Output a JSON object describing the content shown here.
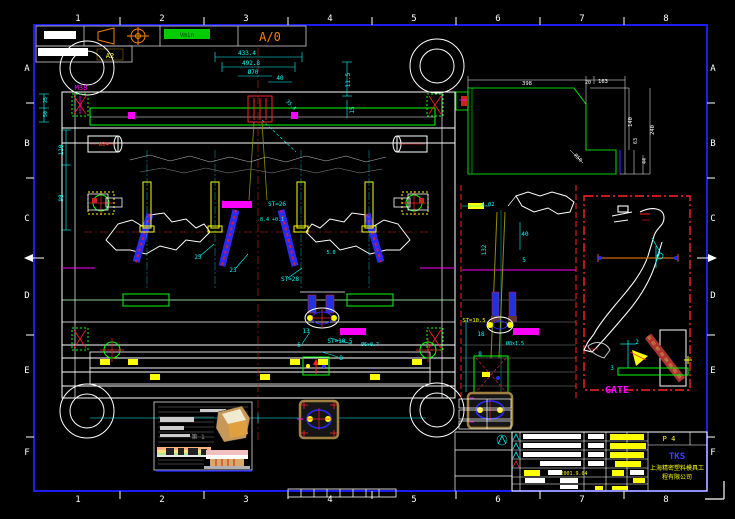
{
  "border": {
    "columns": [
      "1",
      "2",
      "3",
      "4",
      "5",
      "6",
      "7",
      "8"
    ],
    "rows": [
      "A",
      "B",
      "C",
      "D",
      "E",
      "F"
    ]
  },
  "corner": {
    "revision": "A/0",
    "badge": "Vmin",
    "tag": "A2"
  },
  "title_block": {
    "page": "P 4",
    "logo": "TKS",
    "company_line1": "上海精密塑料模具工",
    "company_line2": "程有限公司",
    "date": "2001.9.04"
  },
  "annotations": [
    {
      "text": "M38",
      "x": 81,
      "y": 90,
      "color": "#ff00ff",
      "size": 7
    },
    {
      "text": "433.4",
      "x": 247,
      "y": 55,
      "color": "#00ffff"
    },
    {
      "text": "492.8",
      "x": 251,
      "y": 65,
      "color": "#00ffff"
    },
    {
      "text": "Ø70",
      "x": 253,
      "y": 74,
      "color": "#00ffff"
    },
    {
      "text": "40",
      "x": 280,
      "y": 80,
      "color": "#00ffff"
    },
    {
      "text": "11.5",
      "x": 350,
      "y": 80,
      "color": "#00ffff",
      "rot": -90
    },
    {
      "text": "15",
      "x": 354,
      "y": 110,
      "color": "#00ffff",
      "rot": -90
    },
    {
      "text": "110",
      "x": 63,
      "y": 150,
      "color": "#00ffff",
      "rot": -90
    },
    {
      "text": "98",
      "x": 63,
      "y": 198,
      "color": "#00ffff",
      "rot": -90
    },
    {
      "text": "25",
      "x": 47,
      "y": 100,
      "color": "#00ffff",
      "rot": -90,
      "size": 5
    },
    {
      "text": "50",
      "x": 47,
      "y": 114,
      "color": "#00ffff",
      "rot": -90,
      "size": 5
    },
    {
      "text": "Ø24",
      "x": 104,
      "y": 146,
      "color": "#ff3333",
      "size": 5.5
    },
    {
      "text": "35.4",
      "x": 290,
      "y": 106,
      "color": "#00ffff",
      "rot": 45,
      "size": 5
    },
    {
      "text": "ST=26",
      "x": 277,
      "y": 206,
      "color": "#00ffff"
    },
    {
      "text": "8.4 +0.1",
      "x": 272,
      "y": 221,
      "color": "#00ffff",
      "size": 5
    },
    {
      "text": "ST=28",
      "x": 290,
      "y": 281,
      "color": "#00ffff"
    },
    {
      "text": "25",
      "x": 198,
      "y": 259,
      "color": "#00ffff"
    },
    {
      "text": "23",
      "x": 233,
      "y": 272,
      "color": "#00ffff"
    },
    {
      "text": "5.0",
      "x": 331,
      "y": 254,
      "color": "#00ffff",
      "size": 5
    },
    {
      "text": "13",
      "x": 306,
      "y": 333,
      "color": "#00ffff"
    },
    {
      "text": "5",
      "x": 299,
      "y": 347,
      "color": "#00ffff"
    },
    {
      "text": "ST=10.5",
      "x": 340,
      "y": 343,
      "color": "#00ffff"
    },
    {
      "text": "Ø6×0.7",
      "x": 370,
      "y": 346,
      "color": "#00ffff",
      "size": 5
    },
    {
      "text": "8",
      "x": 341,
      "y": 360,
      "color": "#00ffff"
    },
    {
      "text": "4.02",
      "x": 488,
      "y": 206,
      "color": "#00ffff",
      "size": 5.5
    },
    {
      "text": "40",
      "x": 525,
      "y": 236,
      "color": "#00ffff"
    },
    {
      "text": "132",
      "x": 486,
      "y": 250,
      "color": "#00ffff",
      "rot": -90
    },
    {
      "text": "5",
      "x": 524,
      "y": 262,
      "color": "#00ffff"
    },
    {
      "text": "ST=10.5",
      "x": 474,
      "y": 322,
      "color": "#ffff00",
      "size": 5.5
    },
    {
      "text": "18",
      "x": 481,
      "y": 336,
      "color": "#00ffff"
    },
    {
      "text": "Ø8×1.5",
      "x": 515,
      "y": 345,
      "color": "#00ffff",
      "size": 5
    },
    {
      "text": "8",
      "x": 480,
      "y": 356,
      "color": "#00ffff"
    },
    {
      "text": "GATE",
      "x": 617,
      "y": 393,
      "color": "#ff00ff",
      "size": 10,
      "bold": true
    },
    {
      "text": "2",
      "x": 637,
      "y": 344,
      "color": "#00ffff"
    },
    {
      "text": "3",
      "x": 612,
      "y": 370,
      "color": "#00ffff"
    },
    {
      "text": "398",
      "x": 527,
      "y": 85,
      "color": "#ffffff",
      "size": 5.5
    },
    {
      "text": "20",
      "x": 588,
      "y": 84,
      "color": "#ffffff",
      "size": 5
    },
    {
      "text": "163",
      "x": 603,
      "y": 83,
      "color": "#ffffff",
      "size": 5.5
    },
    {
      "text": "140",
      "x": 632,
      "y": 122,
      "color": "#ffffff",
      "rot": -90,
      "size": 5.5
    },
    {
      "text": "240",
      "x": 654,
      "y": 130,
      "color": "#ffffff",
      "rot": -90,
      "size": 5.5
    },
    {
      "text": "63",
      "x": 637,
      "y": 141,
      "color": "#ffffff",
      "rot": -90,
      "size": 5
    },
    {
      "text": "44",
      "x": 646,
      "y": 161,
      "color": "#ffffff",
      "rot": -90,
      "size": 5
    },
    {
      "text": "R50",
      "x": 577,
      "y": 159,
      "color": "#ffffff",
      "rot": 45,
      "size": 5
    },
    {
      "text": "第 1",
      "x": 198,
      "y": 439,
      "color": "#999999",
      "size": 6
    },
    {
      "text": "2001.9.04",
      "x": 574,
      "y": 475,
      "color": "#ffff00",
      "size": 5
    }
  ]
}
